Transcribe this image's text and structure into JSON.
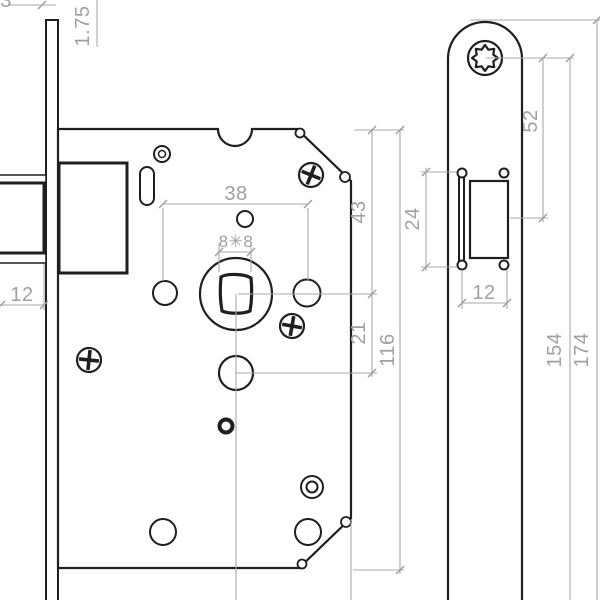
{
  "colors": {
    "line": "#1f1f1f",
    "dim": "#a8a8a8",
    "background": "#ffffff"
  },
  "front_view": {
    "partial_top_dim": "3",
    "faceplate_thickness": "1.75",
    "latch_width": "12",
    "handle_hole_spacing": "38",
    "spindle_square": "8✳8",
    "top_to_handle_center": "43",
    "handle_to_cylinder": "21",
    "case_height": "116"
  },
  "side_view": {
    "screw_to_latch": "52",
    "latch_cutout_height": "24",
    "latch_cutout_width": "12",
    "screw_spacing": "154",
    "faceplate_length": "174"
  }
}
